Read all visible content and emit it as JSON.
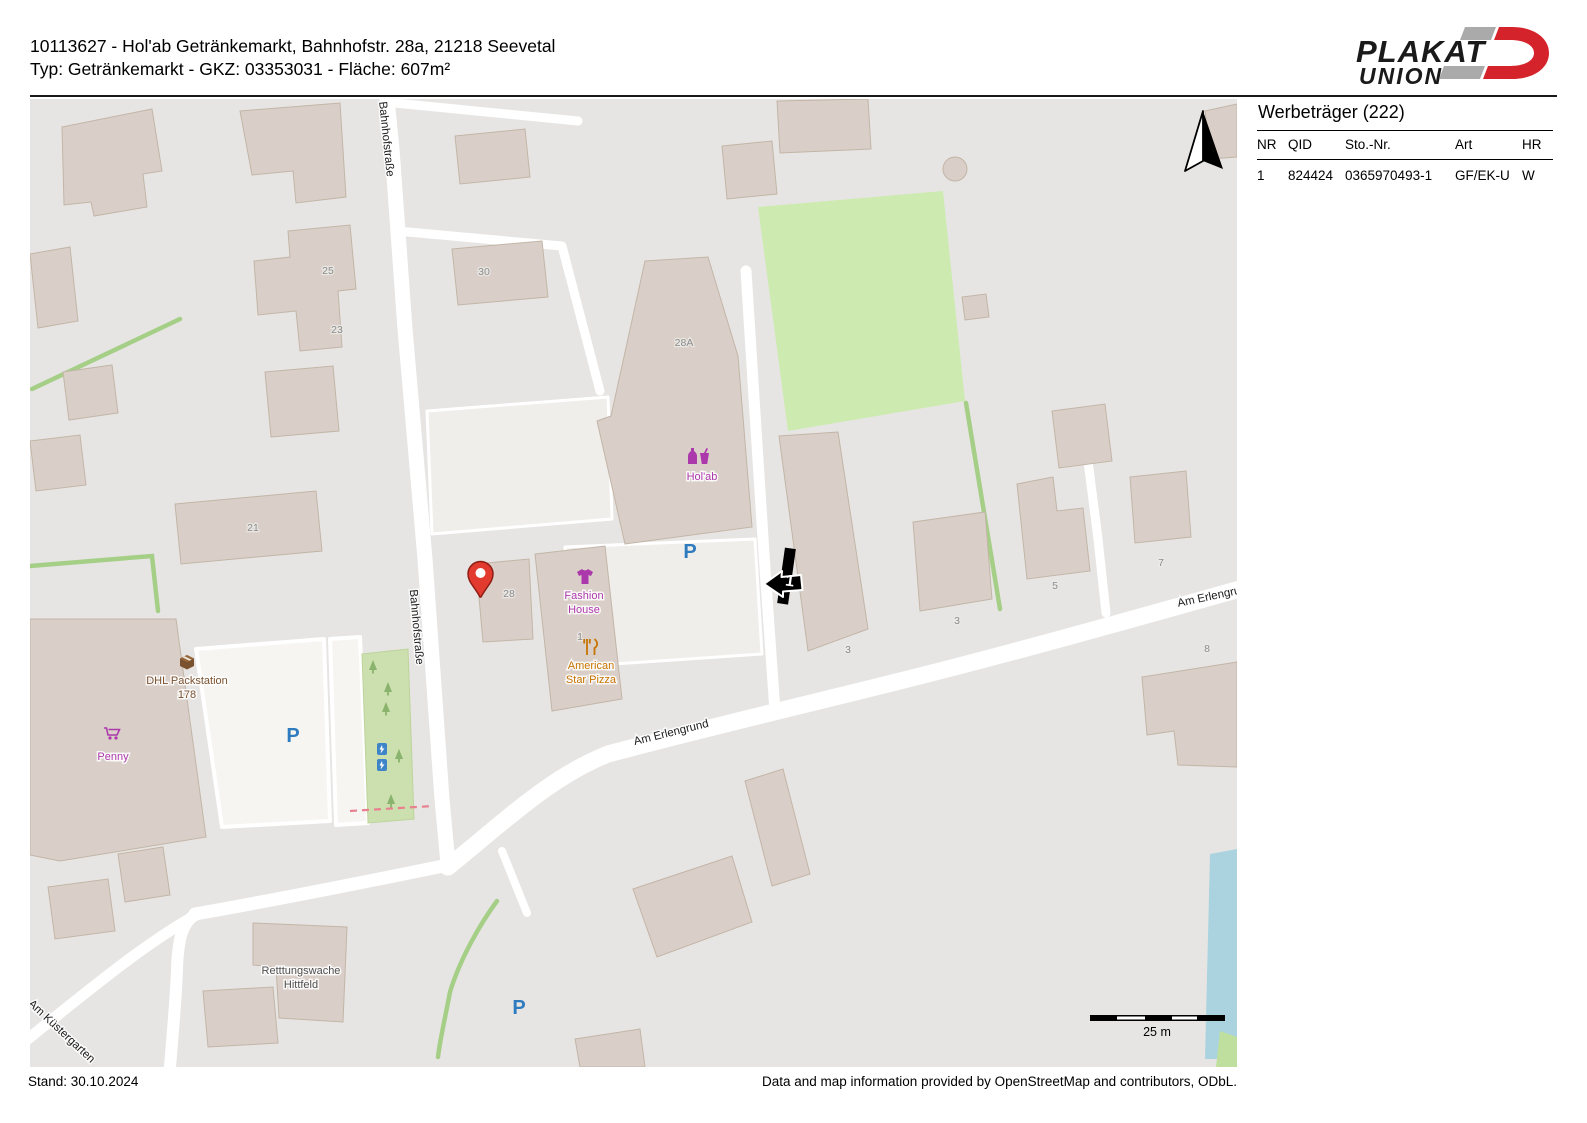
{
  "header": {
    "line1": "10113627 - Hol'ab Getränkemarkt, Bahnhofstr. 28a, 21218 Seevetal",
    "line2": "Typ: Getränkemarkt - GKZ: 03353031 - Fläche: 607m²"
  },
  "logo": {
    "plakat": "PLAKAT",
    "union": "UNION"
  },
  "panel": {
    "title": "Werbeträger (222)",
    "columns": {
      "nr": "NR",
      "qid": "QID",
      "sto": "Sto.-Nr.",
      "art": "Art",
      "hr": "HR"
    },
    "row": {
      "nr": "1",
      "qid": "824424",
      "sto": "0365970493-1",
      "art": "GF/EK-U",
      "hr": "W"
    }
  },
  "map": {
    "streets": {
      "bahnhofstrasse": "Bahnhofstraße",
      "am_erlengrund": "Am Erlengrund",
      "am_kuestergarten": "Am Küstergarten"
    },
    "pois": {
      "holab": "Hol'ab",
      "fashion_line1": "Fashion",
      "fashion_line2": "House",
      "pizza_line1": "American",
      "pizza_line2": "Star Pizza",
      "penny": "Penny",
      "dhl_line1": "DHL Packstation",
      "dhl_line2": "178",
      "rettungswache_line1": "Retttungswache",
      "rettungswache_line2": "Hittfeld"
    },
    "housenumbers": {
      "h25": "25",
      "h23": "23",
      "h21": "21",
      "h30": "30",
      "h28a": "28A",
      "h28": "28",
      "h1": "1",
      "h3a": "3",
      "h3b": "3",
      "h5": "5",
      "h7": "7",
      "h8": "8"
    },
    "parking_symbol": "P",
    "billboard_number": "1",
    "scale_label": "25 m",
    "colors": {
      "brand_red": "#d5232b",
      "poi_purple": "#ac39ac",
      "poi_orange": "#c77400",
      "poi_brown": "#7a5230",
      "parking_blue": "#2f7bbf",
      "marker_red": "#e23a2e",
      "grass": "#cdebb0",
      "water": "#aad3df",
      "building": "#d9cfc8"
    }
  },
  "footer": {
    "stand": "Stand: 30.10.2024",
    "attribution": "Data and map information provided by OpenStreetMap and contributors, ODbL."
  }
}
